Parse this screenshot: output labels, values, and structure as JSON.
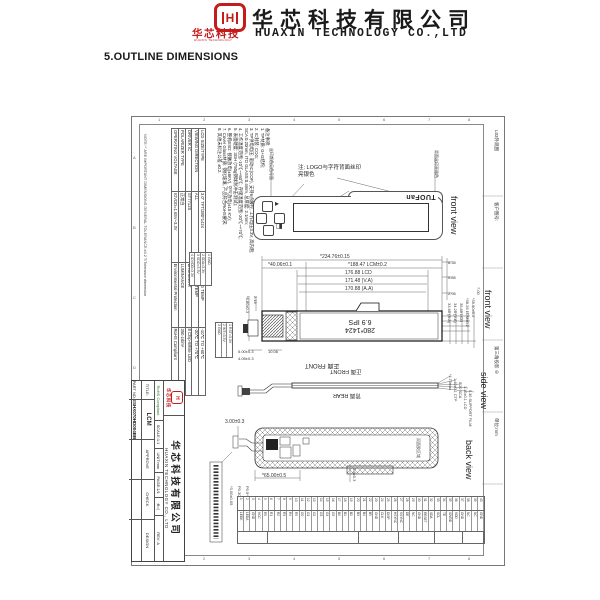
{
  "header": {
    "logo_mark": "H",
    "logo_name": "华芯科技",
    "logo_sub": "HUAXIN TECHNOLOGY",
    "company_cn": "华芯科技有限公司",
    "company_en": "HUAXIN TECHNOLOGY CO.,LTD"
  },
  "section_title": "5.OUTLINE DIMENSIONS",
  "sheet": {
    "tolerance_note": "NOTE:'*' ARE IMPORTANT DIMENSIONS   GENERAL TOLERANCE:±0.2   T/Tolerance dimension",
    "zones": {
      "top": [
        "1",
        "2",
        "3",
        "4",
        "5",
        "6",
        "7",
        "8"
      ],
      "left": [
        "A",
        "B",
        "C",
        "D",
        "E",
        "F"
      ]
    },
    "right_strip": [
      "L03外观图",
      "客户图号:",
      "",
      "第三角投影 ⊕",
      "单位:mm",
      ""
    ],
    "spec_table": {
      "rows": [
        [
          "LCD SIZE/TYPE",
          "3.0\" TFT/280*1424",
          "OPERATING TEMP",
          "-10℃ TO +60℃"
        ],
        [
          "VIEWING DIRECTION",
          "ALL",
          "STORAGE TEMP",
          "-20℃ TO +70℃"
        ],
        [
          "DRIVER IC",
          "ST7712S",
          "BACKLIGHT",
          "8 Chip-White LED"
        ],
        [
          "POLARIZER TYPE",
          "正常白",
          "LUMINANCE",
          "350 cd/m²"
        ],
        [
          "OPERATING VOLTAGE",
          "IOVDD=1.65V~3.3V",
          "Environmental Protection",
          "RoHS Compliant"
        ]
      ]
    },
    "notes": {
      "lines": [
        "备注事项:",
        "1. TP材质: G+G结构;",
        "2. IC封装: COG;",
        "3. TP供电电压: 驱动IC(COF), 支持6点触控, 工作电压3.3V, 高内阻;",
        "   SCA:0.20mm, ITO GLASS:0.4mm, 总厚度: 2.1mm;",
        "4. 工作温度范围:-10℃~+60℃; 存储温度范围:-20℃~+70℃;",
        "5. 表面硬度: 3GH (750g钢球耐冲击测试);",
        "6. 整机ESD: 接触放电(±8KV), 空气放电(±15 KV);",
        "7. Cover Glass材质: 钢化玻璃, 产品符合RoHS要求;",
        "8. 其他未标注公差 ±0.2."
      ]
    },
    "sub_table_a": [
      "1 GND",
      "2 SDA=3.3V",
      "3 SDO=3.3V",
      "4 IOVDD=3.3V"
    ],
    "sub_table_b": [
      "1 RST=3.3V",
      "2 INT=3.3V",
      "3 GND"
    ],
    "front_view": {
      "label": "front view",
      "brand": "TUOFan",
      "note_line1": "注: LOGO与字符背面丝印",
      "note_line2": "亮银色",
      "left_note": "丝印颜色见色号图",
      "right_note": "背面丝印亮银色"
    },
    "dim_front": {
      "label": "front view",
      "center_line1": "280*1424",
      "center_line2": "6.9 IPS",
      "bottom_label": "正面 FRONT",
      "top_dims": [
        "*234.76±0.15",
        "*40.06±0.1",
        "*188.47 LCM±0.2",
        "176.88 LCD",
        "171.48 (V.A)",
        "170.88 (A.A)"
      ],
      "right_dims": [
        "6.35",
        "0.85",
        "2.95"
      ],
      "right_stack": [
        "33.60 (A.A)",
        "34.20 (V.A)",
        "35.80 LCD",
        "*38.26 LCM±0.2",
        "*39.80±0.2"
      ],
      "right_stack_outer": "7.00",
      "left_dims": [
        "2.19",
        "*6.80±0.3",
        "5.00±0.3",
        "4.05±0.3",
        "10.06"
      ]
    },
    "side_view": {
      "label": "side view",
      "front_label": "正面 FRONT",
      "rear_label": "背面 REAR",
      "callouts": [
        "*4.70max",
        "1.40±0.1 CTP",
        "0.20 SCA",
        "1.10±0.1 LCD",
        "0.30 SUPPORT FILM"
      ]
    },
    "back_view": {
      "label": "back view",
      "dim_top": "3.00±0.3",
      "dim_bottom": "*65.00±0.5",
      "dim_notch": "3.6±0.3",
      "inner_label": "双面胶区域"
    },
    "fpc_detail": {
      "dims": [
        "*3.00±0.05",
        "P0.30±0.05",
        "P0.5*39=19.50±0.3"
      ]
    },
    "pin_table": {
      "count": 40,
      "names": [
        "LEDK",
        "LEDA",
        "GND",
        "VCC",
        "R0",
        "R1",
        "R2",
        "R3",
        "R4",
        "R5",
        "G0",
        "G1",
        "G2",
        "G3",
        "G4",
        "G5",
        "B0",
        "B1",
        "B2",
        "B3",
        "B4",
        "B5",
        "GND",
        "CLK",
        "DISP",
        "HSYNC",
        "VSYNC",
        "DE",
        "NC",
        "GND",
        "RESET",
        "SDA",
        "SCL",
        "TE",
        "IOVDD",
        "VDD",
        "GND",
        "NC",
        "NC",
        "GND"
      ]
    },
    "title_block": {
      "logo_mark": "H",
      "logo_name": "华芯科技",
      "company_cn": "华芯科技有限公司",
      "company_en": "HUAXIN TECHNOLOGY CO., LTD",
      "rohs": "RoHS Compliant",
      "scale": "SCALE:1:1",
      "unit": "UNIT:mm",
      "page": "PAGE:1/1",
      "projection": "⊕◁",
      "rev": "REV: A",
      "title_label": "TITLE:",
      "title_value": "LCM",
      "part_label": "PART NO:",
      "part_value": "ESHX070HD004BB",
      "approve": "APPROVE",
      "check": "CHECK",
      "design": "DESIGN"
    }
  }
}
